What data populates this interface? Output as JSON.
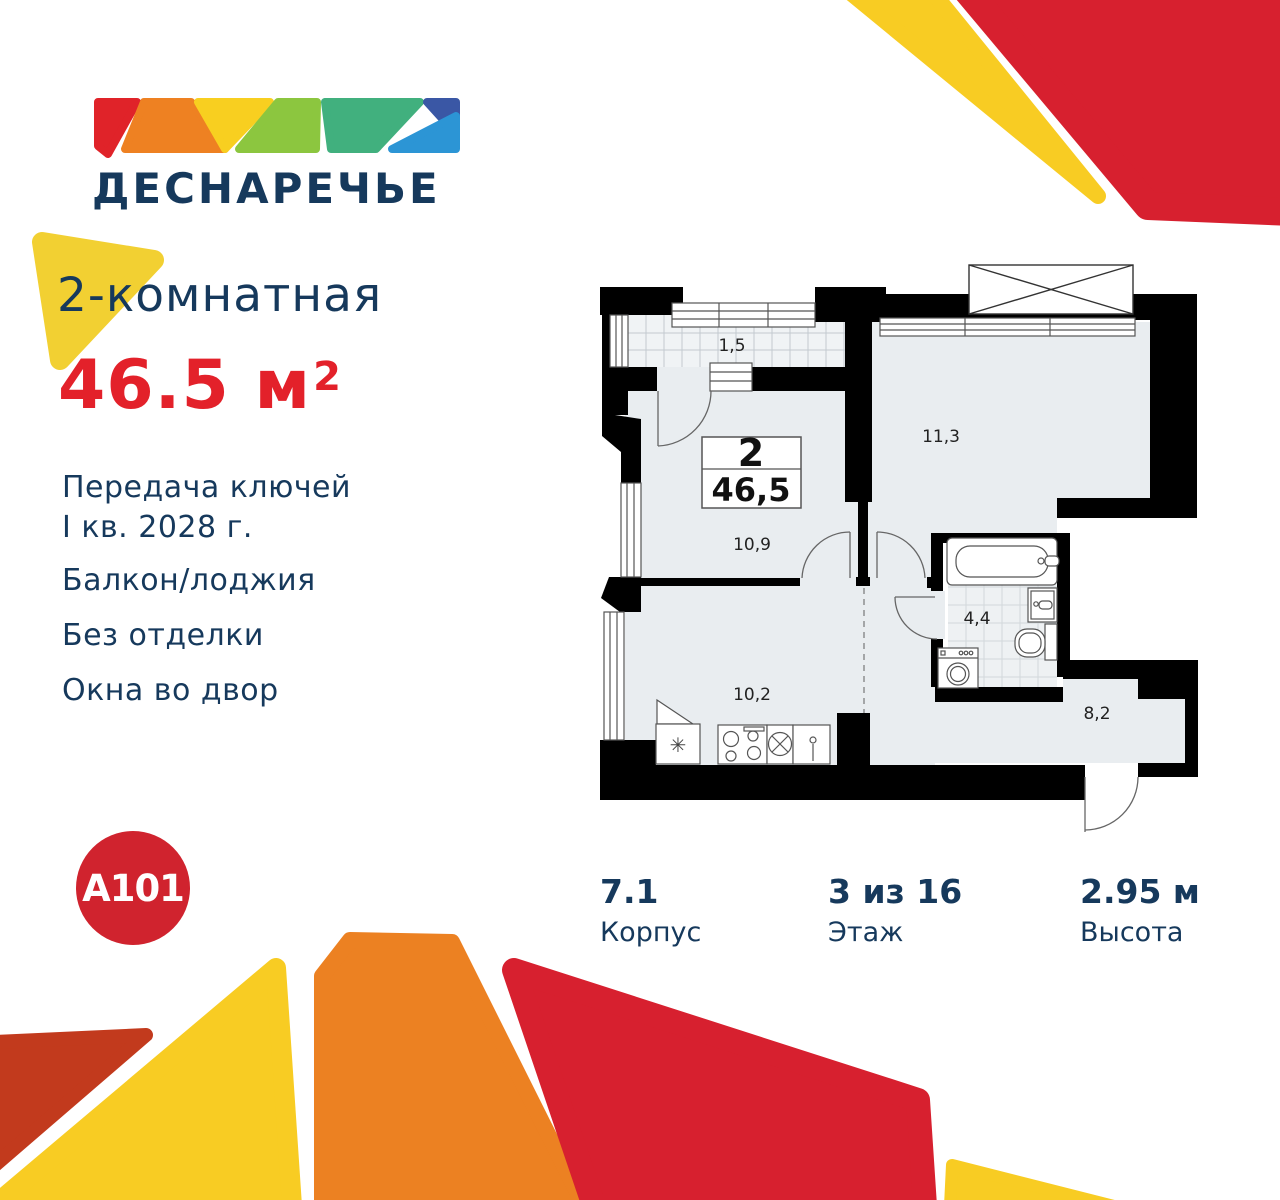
{
  "brand": {
    "name": "ДЕСНАРЕЧЬЕ",
    "developer_logo": "A101"
  },
  "listing": {
    "type": "2-комнатная",
    "area_value": "46.5",
    "area_unit": "м",
    "area_exponent": "2",
    "features": [
      "Передача ключей",
      "I кв. 2028 г.",
      "Балкон/лоджия",
      "Без отделки",
      "Окна во двор"
    ]
  },
  "floor_plan": {
    "info_box": {
      "rooms": "2",
      "area": "46,5"
    },
    "room_areas": {
      "balcony": "1,5",
      "bedroom": "11,3",
      "room": "10,9",
      "kitchen_living": "10,2",
      "bathroom": "4,4",
      "hallway": "8,2"
    }
  },
  "stats": [
    {
      "value": "7.1",
      "label": "Корпус"
    },
    {
      "value": "3 из 16",
      "label": "Этаж"
    },
    {
      "value": "2.95 м",
      "label": "Высота"
    }
  ],
  "colors": {
    "navy": "#16395c",
    "price_red": "#e3212a",
    "brand_red": "#d7202f",
    "dark_red": "#c23a1d",
    "yellow": "#f8cc23",
    "orange": "#ec8122",
    "light_green": "#8cc63f",
    "teal": "#41b07e",
    "dark_blue": "#3a57a5",
    "light_blue": "#2c95d5",
    "a101_red": "#d0232e",
    "plan_floor": "#e9edf0"
  }
}
